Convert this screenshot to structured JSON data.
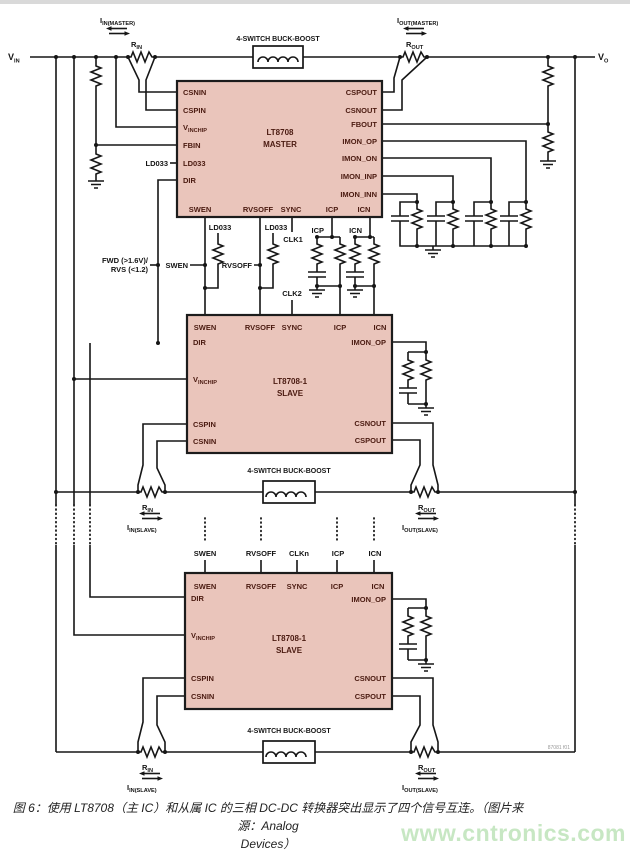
{
  "figure": {
    "caption_line1": "图 6：使用 LT8708（主 IC）和从属 IC 的三相 DC-DC 转换器突出显示了四个信号互连。（图片来源：Analog",
    "caption_line2": "Devices）",
    "watermark": "www.cntronics.com",
    "fig_code": "87081 f01"
  },
  "colors": {
    "chip_fill": "#eac5bb",
    "wire": "#161616",
    "pin_text": "#4a1a10",
    "watermark_green": "#c7e7c3"
  },
  "rails": {
    "vin_main": "V",
    "vin_sub": "IN",
    "vo_main": "V",
    "vo_sub": "O"
  },
  "buck_label": "4-SWITCH BUCK-BOOST",
  "sense": {
    "i_main": "I",
    "r_main": "R",
    "iin_master_sub": "IN(MASTER)",
    "iout_master_sub": "OUT(MASTER)",
    "iin_slave_sub": "IN(SLAVE)",
    "iout_slave_sub": "OUT(SLAVE)",
    "rin_sub": "IN",
    "rout_sub": "OUT"
  },
  "master": {
    "name1": "LT8708",
    "name2": "MASTER",
    "csnin": "CSNIN",
    "cspin": "CSPIN",
    "vinchip_main": "V",
    "vinchip_sub": "INCHIP",
    "fbin": "FBIN",
    "ld033": "LD033",
    "dir": "DIR",
    "swen": "SWEN",
    "rvsoff": "RVSOFF",
    "sync": "SYNC",
    "icp": "ICP",
    "icn": "ICN",
    "cspout": "CSPOUT",
    "csnout": "CSNOUT",
    "fbout": "FBOUT",
    "imon_op": "IMON_OP",
    "imon_on": "IMON_ON",
    "imon_inp": "IMON_INP",
    "imon_inn": "IMON_INN"
  },
  "slave": {
    "name1": "LT8708-1",
    "name2": "SLAVE",
    "swen": "SWEN",
    "rvsoff": "RVSOFF",
    "sync": "SYNC",
    "icp": "ICP",
    "icn": "ICN",
    "dir": "DIR",
    "vinchip_main": "V",
    "vinchip_sub": "INCHIP",
    "cspin": "CSPIN",
    "csnin": "CSNIN",
    "imon_op": "IMON_OP",
    "csnout": "CSNOUT",
    "cspout": "CSPOUT"
  },
  "signals": {
    "ld033": "LD033",
    "swen": "SWEN",
    "rvsoff": "RVSOFF",
    "clk1": "CLK1",
    "clk2": "CLK2",
    "clkn": "CLKn",
    "icp": "ICP",
    "icn": "ICN",
    "fwd_line1": "FWD (>1.6V)/",
    "fwd_line2": "RVS (<1.2)"
  }
}
